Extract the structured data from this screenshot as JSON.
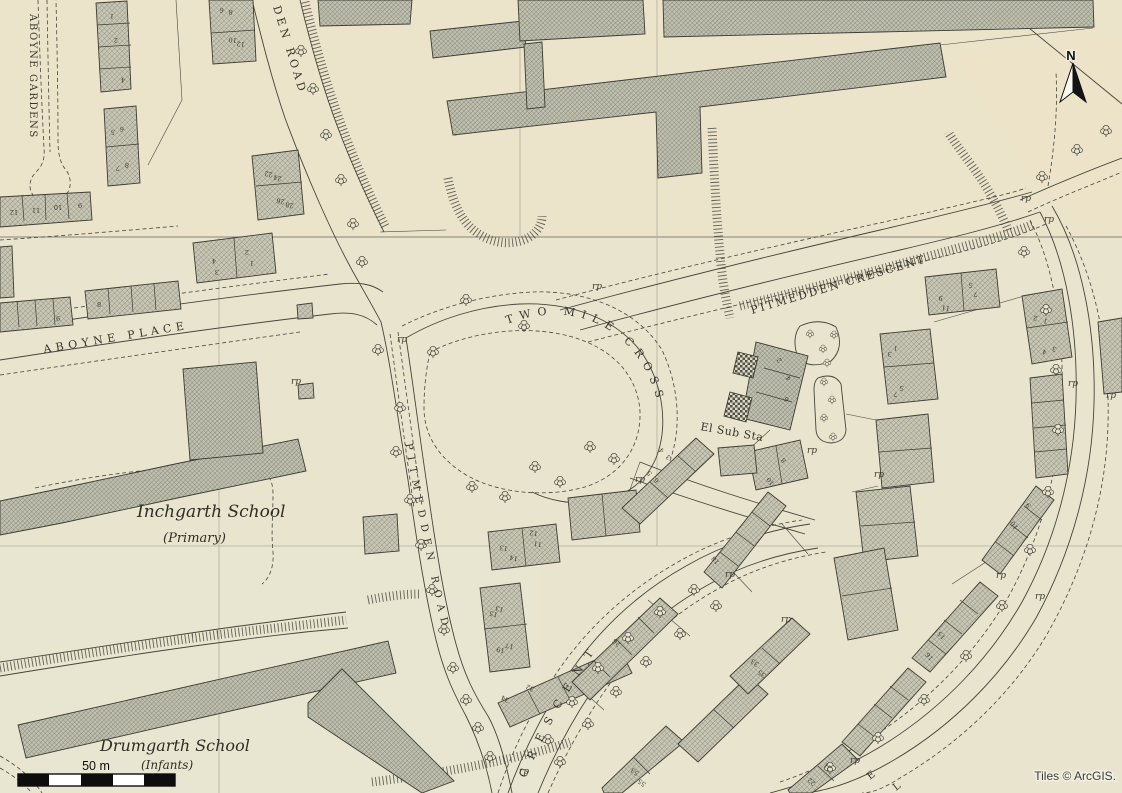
{
  "map": {
    "colors": {
      "paper": "#e9e4cd",
      "paper_top_tint": "#ece2c7",
      "paper_lower_tint": "#e7e7d4",
      "ink": "#45453b",
      "building_fill": "#c8c7b5",
      "hatch_line": "#6e6e5d",
      "checker_dark": "#52524a",
      "grid_faint": "#b0afa0",
      "grid_strong": "#84847b",
      "attribution_text": "#3d3d3d",
      "halo": "#f1eedd"
    },
    "road_labels": [
      {
        "id": "aboyne-gardens-label",
        "text": "ABOYNE GARDENS",
        "x": 30,
        "y": 14,
        "rotate": 90,
        "size": 10,
        "spacing": 1.6
      },
      {
        "id": "den-road-label",
        "text": "DEN ROAD",
        "x": 273,
        "y": 7,
        "rotate": 73,
        "size": 11,
        "spacing": 3.5
      },
      {
        "id": "aboyne-place-label",
        "text": "ABOYNE PLACE",
        "x": 44,
        "y": 353,
        "rotate": -9.5,
        "size": 11,
        "spacing": 4.5
      },
      {
        "id": "two-mile-cross-label",
        "text": "TWO MILE CROSS",
        "path": "gp-two-mile",
        "size": 11,
        "spacing": 6.5,
        "offset": 10
      },
      {
        "id": "pitmedden-crescent-label",
        "text": "PITMEDDEN CRESCENT",
        "x": 752,
        "y": 314,
        "rotate": -16.5,
        "size": 11,
        "spacing": 2.2
      },
      {
        "id": "pitmedden-road-label",
        "text": "PITMEDDEN ROAD",
        "path": "gp-pitmedden-rd",
        "size": 10,
        "spacing": 6.5,
        "offset": 8
      },
      {
        "id": "crescent-label",
        "text": "CRESCENT",
        "path": "gp-crescent",
        "size": 11,
        "spacing": 11,
        "offset": 4
      },
      {
        "id": "el-sub-sta-label",
        "text": "El Sub Sta",
        "x": 700,
        "y": 430,
        "rotate": 10,
        "size": 11,
        "spacing": 0.5
      },
      {
        "id": "partial-road-letter-e",
        "text": "E",
        "x": 870,
        "y": 780,
        "rotate": -38,
        "size": 10,
        "spacing": 0
      },
      {
        "id": "partial-road-letter-l",
        "text": "L",
        "x": 896,
        "y": 791,
        "rotate": -38,
        "size": 10,
        "spacing": 0
      }
    ],
    "place_labels": [
      {
        "id": "inchgarth-school-label",
        "text": "Inchgarth School",
        "x": 137,
        "y": 517,
        "size": 17
      },
      {
        "id": "inchgarth-type-label",
        "text": "(Primary)",
        "x": 163,
        "y": 542,
        "size": 13
      },
      {
        "id": "drumgarth-school-label",
        "text": "Drumgarth School",
        "x": 100,
        "y": 751,
        "size": 16
      },
      {
        "id": "drumgarth-type-label",
        "text": "(Infants)",
        "x": 141,
        "y": 769,
        "size": 12
      }
    ],
    "rp_label": "rp",
    "rp_positions": [
      [
        592,
        289
      ],
      [
        397,
        342
      ],
      [
        291,
        384
      ],
      [
        1021,
        201
      ],
      [
        1044,
        222
      ],
      [
        874,
        477
      ],
      [
        1068,
        386
      ],
      [
        1106,
        398
      ],
      [
        635,
        482
      ],
      [
        725,
        577
      ],
      [
        807,
        453
      ],
      [
        781,
        622
      ],
      [
        996,
        578
      ],
      [
        1035,
        599
      ],
      [
        850,
        763
      ],
      [
        519,
        774
      ]
    ],
    "house_numbers": [
      {
        "t": "1",
        "x": 112,
        "y": 14,
        "r": 185
      },
      {
        "t": "2",
        "x": 116,
        "y": 38,
        "r": 185
      },
      {
        "t": "4",
        "x": 123,
        "y": 78,
        "r": 185
      },
      {
        "t": "5",
        "x": 113,
        "y": 130,
        "r": 185
      },
      {
        "t": "6",
        "x": 122,
        "y": 127,
        "r": 185
      },
      {
        "t": "7",
        "x": 118,
        "y": 166,
        "r": 185
      },
      {
        "t": "8",
        "x": 127,
        "y": 163,
        "r": 185
      },
      {
        "t": "12",
        "x": 14,
        "y": 210,
        "r": 180
      },
      {
        "t": "11",
        "x": 36,
        "y": 208,
        "r": 180
      },
      {
        "t": "10",
        "x": 58,
        "y": 205,
        "r": 180
      },
      {
        "t": "9",
        "x": 80,
        "y": 203,
        "r": 180
      },
      {
        "t": "6",
        "x": 222,
        "y": 8,
        "r": 188
      },
      {
        "t": "8",
        "x": 231,
        "y": 10,
        "r": 188
      },
      {
        "t": "10",
        "x": 233,
        "y": 38,
        "r": 188
      },
      {
        "t": "12",
        "x": 241,
        "y": 42,
        "r": 188
      },
      {
        "t": "22",
        "x": 269,
        "y": 172,
        "r": 192
      },
      {
        "t": "24",
        "x": 278,
        "y": 176,
        "r": 192
      },
      {
        "t": "26",
        "x": 281,
        "y": 199,
        "r": 192
      },
      {
        "t": "28",
        "x": 290,
        "y": 203,
        "r": 192
      },
      {
        "t": "9",
        "x": 58,
        "y": 316,
        "r": 180
      },
      {
        "t": "8",
        "x": 99,
        "y": 302,
        "r": 180
      },
      {
        "t": "4",
        "x": 214,
        "y": 259,
        "r": 185
      },
      {
        "t": "3",
        "x": 217,
        "y": 270,
        "r": 185
      },
      {
        "t": "2",
        "x": 247,
        "y": 250,
        "r": 185
      },
      {
        "t": "1",
        "x": 252,
        "y": 261,
        "r": 185
      },
      {
        "t": "13",
        "x": 504,
        "y": 546,
        "r": 190
      },
      {
        "t": "14",
        "x": 514,
        "y": 556,
        "r": 190
      },
      {
        "t": "11",
        "x": 538,
        "y": 542,
        "r": 190
      },
      {
        "t": "12",
        "x": 534,
        "y": 531,
        "r": 190
      },
      {
        "t": "15",
        "x": 494,
        "y": 612,
        "r": 195
      },
      {
        "t": "13",
        "x": 500,
        "y": 607,
        "r": 195
      },
      {
        "t": "19",
        "x": 501,
        "y": 648,
        "r": 195
      },
      {
        "t": "17",
        "x": 510,
        "y": 644,
        "r": 195
      },
      {
        "t": "34",
        "x": 506,
        "y": 697,
        "r": 205
      },
      {
        "t": "32",
        "x": 531,
        "y": 686,
        "r": 205
      },
      {
        "t": "26",
        "x": 618,
        "y": 641,
        "r": 222
      },
      {
        "t": "18",
        "x": 717,
        "y": 559,
        "r": 230
      },
      {
        "t": "4",
        "x": 663,
        "y": 449,
        "r": 228
      },
      {
        "t": "3",
        "x": 670,
        "y": 456,
        "r": 228
      },
      {
        "t": "5",
        "x": 651,
        "y": 472,
        "r": 228
      },
      {
        "t": "6",
        "x": 658,
        "y": 479,
        "r": 228
      },
      {
        "t": "2",
        "x": 781,
        "y": 359,
        "r": 235
      },
      {
        "t": "4",
        "x": 790,
        "y": 377,
        "r": 235
      },
      {
        "t": "6",
        "x": 788,
        "y": 398,
        "r": 235
      },
      {
        "t": "8",
        "x": 785,
        "y": 459,
        "r": 230
      },
      {
        "t": "10",
        "x": 772,
        "y": 480,
        "r": 230
      },
      {
        "t": "9",
        "x": 941,
        "y": 296,
        "r": 188
      },
      {
        "t": "11",
        "x": 946,
        "y": 306,
        "r": 188
      },
      {
        "t": "5",
        "x": 971,
        "y": 283,
        "r": 188
      },
      {
        "t": "7",
        "x": 976,
        "y": 292,
        "r": 188
      },
      {
        "t": "1",
        "x": 896,
        "y": 346,
        "r": 190
      },
      {
        "t": "3",
        "x": 890,
        "y": 352,
        "r": 190
      },
      {
        "t": "5",
        "x": 902,
        "y": 386,
        "r": 190
      },
      {
        "t": "7",
        "x": 896,
        "y": 392,
        "r": 190
      },
      {
        "t": "2",
        "x": 1036,
        "y": 316,
        "r": 198
      },
      {
        "t": "1",
        "x": 1046,
        "y": 319,
        "r": 198
      },
      {
        "t": "4",
        "x": 1045,
        "y": 350,
        "r": 198
      },
      {
        "t": "3",
        "x": 1055,
        "y": 347,
        "r": 198
      },
      {
        "t": "9",
        "x": 1030,
        "y": 504,
        "r": 235
      },
      {
        "t": "10",
        "x": 1016,
        "y": 524,
        "r": 235
      },
      {
        "t": "15",
        "x": 943,
        "y": 634,
        "r": 228
      },
      {
        "t": "16",
        "x": 931,
        "y": 655,
        "r": 228
      },
      {
        "t": "33",
        "x": 756,
        "y": 661,
        "r": 215
      },
      {
        "t": "35",
        "x": 763,
        "y": 672,
        "r": 215
      },
      {
        "t": "53",
        "x": 636,
        "y": 770,
        "r": 215
      },
      {
        "t": "55",
        "x": 643,
        "y": 781,
        "r": 215
      },
      {
        "t": "21",
        "x": 829,
        "y": 765,
        "r": 220
      },
      {
        "t": "22",
        "x": 813,
        "y": 780,
        "r": 220
      }
    ],
    "trees": [
      [
        301,
        51
      ],
      [
        313,
        89
      ],
      [
        326,
        135
      ],
      [
        341,
        180
      ],
      [
        353,
        224
      ],
      [
        362,
        262
      ],
      [
        378,
        350
      ],
      [
        400,
        408
      ],
      [
        396,
        452
      ],
      [
        410,
        500
      ],
      [
        421,
        545
      ],
      [
        432,
        590
      ],
      [
        444,
        630
      ],
      [
        453,
        668
      ],
      [
        466,
        700
      ],
      [
        478,
        728
      ],
      [
        490,
        757
      ],
      [
        433,
        352
      ],
      [
        466,
        300
      ],
      [
        524,
        326
      ],
      [
        472,
        487
      ],
      [
        505,
        497
      ],
      [
        535,
        467
      ],
      [
        560,
        482
      ],
      [
        590,
        447
      ],
      [
        614,
        459
      ],
      [
        548,
        740
      ],
      [
        572,
        702
      ],
      [
        598,
        668
      ],
      [
        628,
        638
      ],
      [
        660,
        612
      ],
      [
        694,
        590
      ],
      [
        560,
        762
      ],
      [
        588,
        724
      ],
      [
        616,
        692
      ],
      [
        646,
        662
      ],
      [
        680,
        634
      ],
      [
        716,
        606
      ],
      [
        1024,
        252
      ],
      [
        1046,
        310
      ],
      [
        1056,
        370
      ],
      [
        1058,
        430
      ],
      [
        1048,
        492
      ],
      [
        1030,
        550
      ],
      [
        1002,
        606
      ],
      [
        966,
        656
      ],
      [
        924,
        700
      ],
      [
        878,
        738
      ],
      [
        830,
        768
      ],
      [
        1042,
        177
      ],
      [
        1077,
        150
      ],
      [
        1106,
        131
      ],
      [
        810,
        334,
        0.7
      ],
      [
        823,
        349,
        0.7
      ],
      [
        834,
        335,
        0.7
      ],
      [
        827,
        363,
        0.7
      ],
      [
        824,
        382,
        0.7
      ],
      [
        832,
        400,
        0.7
      ],
      [
        824,
        418,
        0.7
      ],
      [
        833,
        437,
        0.7
      ]
    ],
    "north_arrow_label": "N",
    "scale_bar_label": "50 m",
    "attribution": "Tiles © ArcGIS."
  }
}
